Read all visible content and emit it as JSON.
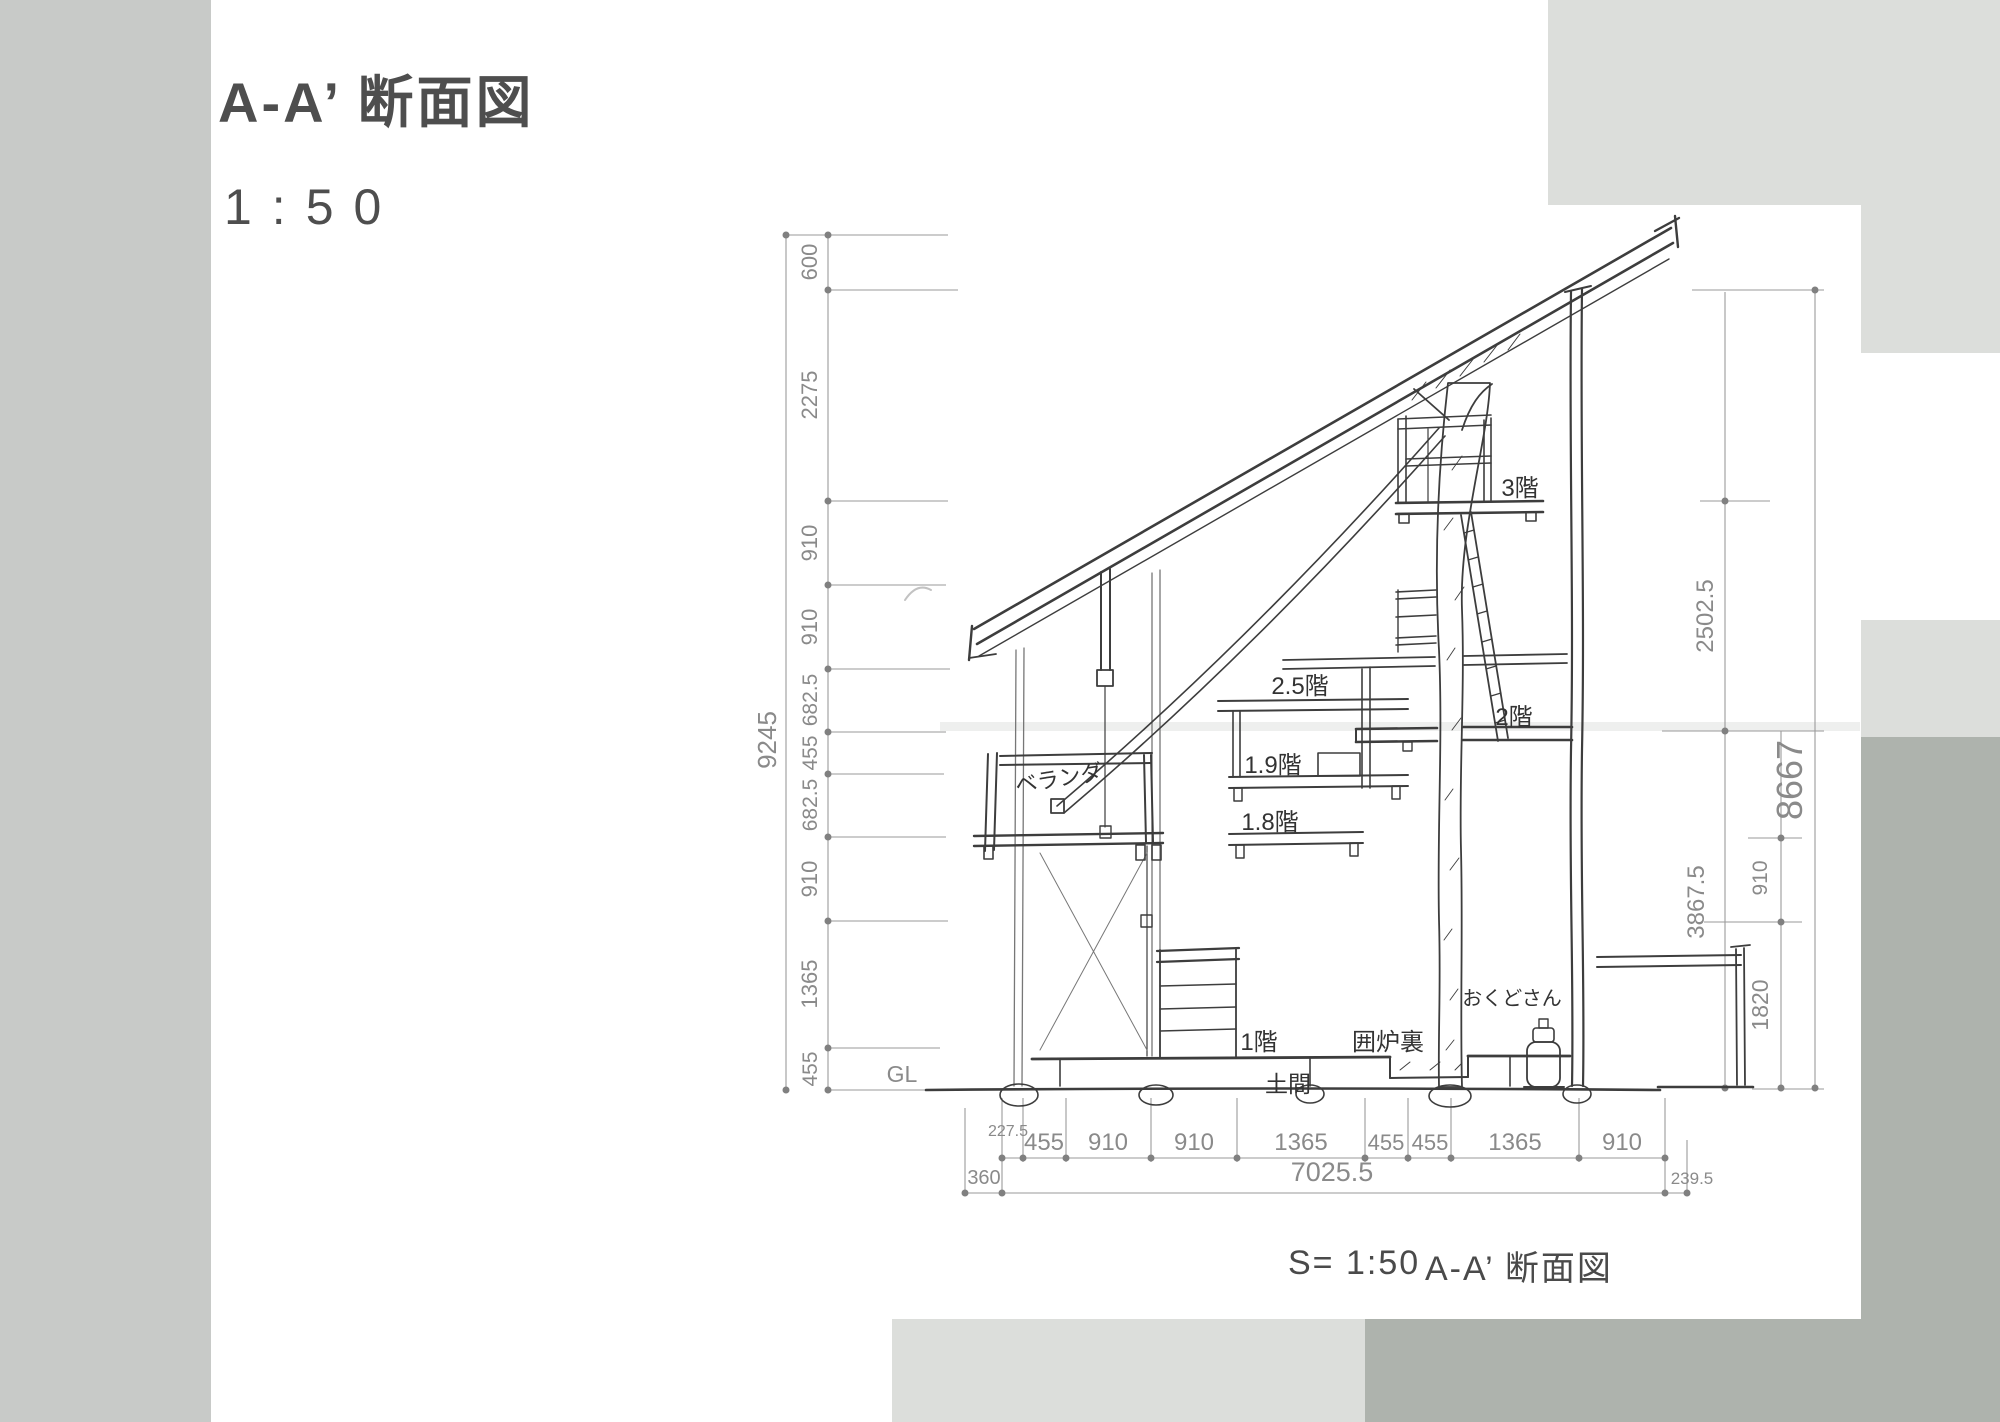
{
  "header": {
    "title": "A-A’ 断面図",
    "scale": "1:50"
  },
  "caption": {
    "scale": "S= 1:50",
    "title": "A-A’ 断面図"
  },
  "colors": {
    "left_strip": "#c8cac8",
    "light_gray": "#dcdedb",
    "dark_gray": "#aeb3ad",
    "pencil": "#8a8a8a",
    "ink": "#3d3d3d"
  },
  "dims": {
    "left": {
      "total": "9245",
      "chain": [
        "600",
        "2275",
        "910",
        "910",
        "682.5",
        "455",
        "682.5",
        "910",
        "1365",
        "455"
      ]
    },
    "right": {
      "total": "8667",
      "upper_chain": [
        "2502.5",
        "3867.5"
      ],
      "lower_chain": [
        "910",
        "1820"
      ]
    },
    "bottom": {
      "chain": [
        "227.5",
        "455",
        "910",
        "910",
        "1365",
        "455",
        "455",
        "1365",
        "910"
      ],
      "total": "7025.5",
      "left_offset": "360",
      "right_offset": "239.5"
    },
    "ground": "GL"
  },
  "labels": {
    "veranda": "ベランダ",
    "floor3": "3階",
    "floor25": "2.5階",
    "floor2": "2階",
    "floor19": "1.9階",
    "floor18": "1.8階",
    "floor1": "1階",
    "irori": "囲炉裏",
    "doma": "土間",
    "okudo": "おくどさん"
  }
}
